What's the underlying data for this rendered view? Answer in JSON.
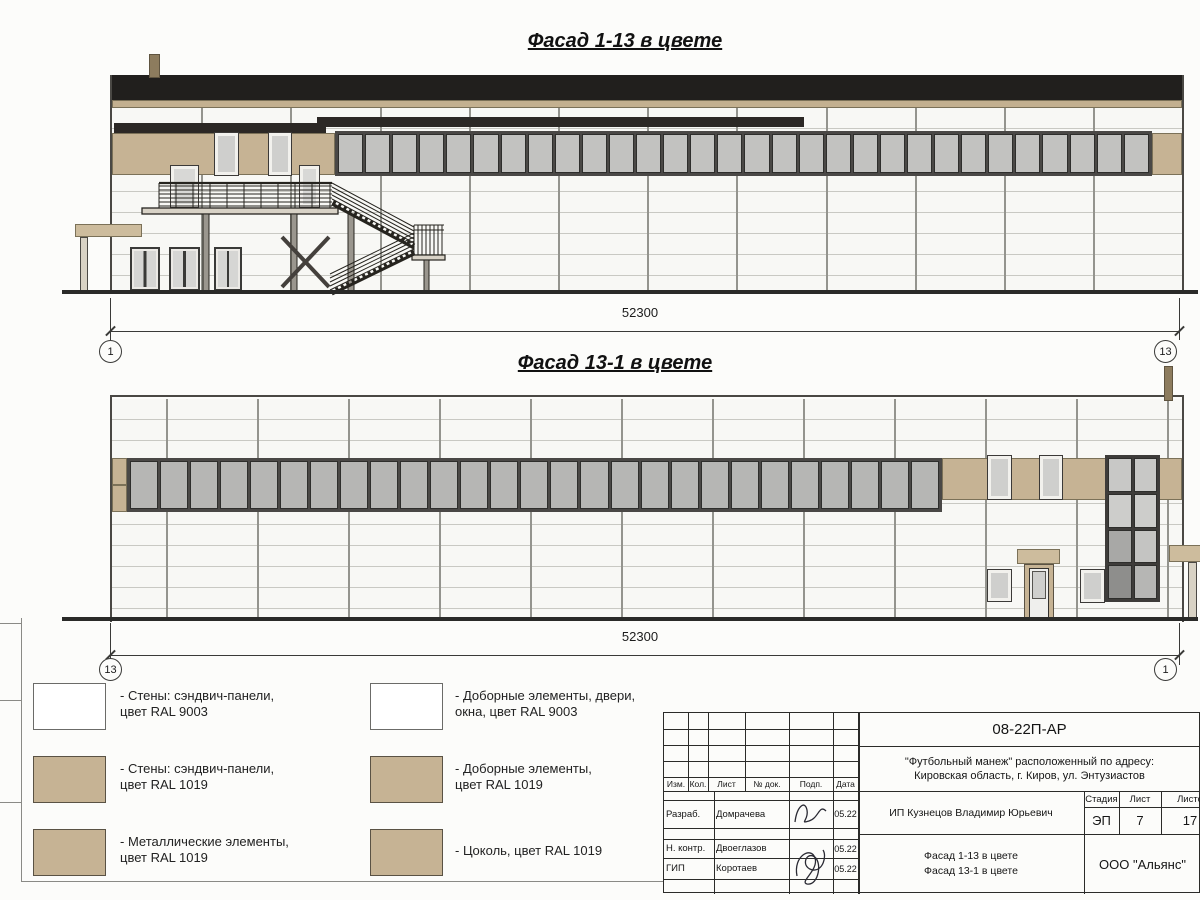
{
  "sheet_name": "Фасады в цвете — лист проекта",
  "colors": {
    "ral9003_white": "#ffffff",
    "ral1019_tan": "#c6b394",
    "roof_black": "#211f1d",
    "glass_gray": "#c2c2c0"
  },
  "facade1": {
    "title": "Фасад 1-13 в цвете",
    "dim": "52300",
    "axis_left": "1",
    "axis_right": "13"
  },
  "facade2": {
    "title": "Фасад 13-1 в цвете",
    "dim": "52300",
    "axis_left": "13",
    "axis_right": "1"
  },
  "legend": {
    "items": [
      {
        "swatch": "white",
        "label": "- Стены: сэндвич-панели,\nцвет RAL 9003"
      },
      {
        "swatch": "tan",
        "label": "- Стены: сэндвич-панели,\nцвет RAL 1019"
      },
      {
        "swatch": "tan",
        "label": "- Металлические элементы,\nцвет RAL 1019"
      },
      {
        "swatch": "white",
        "label": "- Доборные элементы, двери,\nокна, цвет RAL 9003"
      },
      {
        "swatch": "tan",
        "label": "- Доборные элементы,\nцвет RAL 1019"
      },
      {
        "swatch": "tan",
        "label": "- Цоколь, цвет RAL 1019"
      }
    ]
  },
  "titleblock": {
    "doc_code": "08-22П-АР",
    "address": "\"Футбольный манеж\" расположенный по адресу:\nКировская область, г. Киров, ул. Энтузиастов",
    "cols": {
      "izm": "Изм.",
      "kol": "Кол.",
      "list": "Лист",
      "doc": "№ док.",
      "podp": "Подп.",
      "data": "Дата"
    },
    "rows": [
      {
        "role": "Разраб.",
        "name": "Домрачева",
        "date": "05.22"
      },
      {
        "role": "Н. контр.",
        "name": "Двоеглазов",
        "date": "05.22"
      },
      {
        "role": "ГИП",
        "name": "Коротаев",
        "date": "05.22"
      }
    ],
    "client": "ИП Кузнецов Владимир Юрьевич",
    "stage": {
      "label": "Стадия",
      "value": "ЭП"
    },
    "sheet": {
      "label": "Лист",
      "value": "7"
    },
    "sheets_total": {
      "label": "Листов",
      "value": "17"
    },
    "sheet_title": "Фасад 1-13 в цвете\nФасад 13-1 в цвете",
    "company": "ООО \"Альянс\""
  }
}
